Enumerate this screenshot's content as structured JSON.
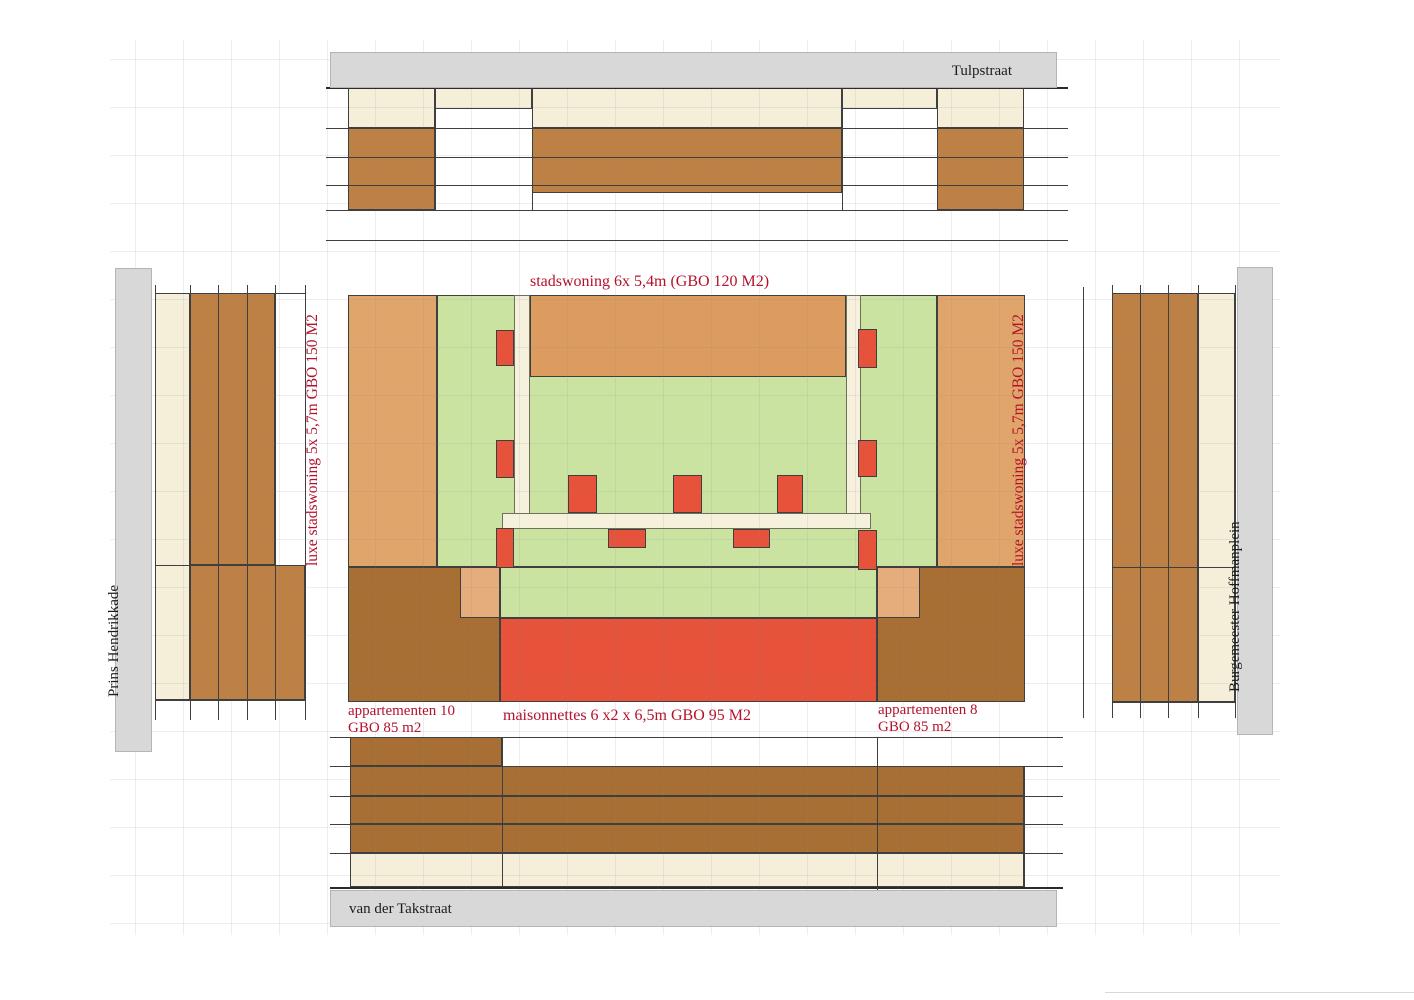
{
  "colors": {
    "cream": "#F5EFD9",
    "green": "#CBE3A0",
    "tan": "#E0A56B",
    "tan_dark": "#DC9B5F",
    "tan_light": "#E4AD7B",
    "brown": "#BE8145",
    "brown_dark": "#A86F35",
    "red": "#E7523A",
    "bar_white": "#F6F1DD",
    "gray_bar": "#D8D8D8",
    "line": "#3F3F3F",
    "line_dark": "#2B2B2B",
    "red_text": "#B4122C",
    "black_text": "#1C1C1C"
  },
  "streets": {
    "top": "Tulpstraat",
    "bottom": "van der Takstraat",
    "left": "Prins Hendrikkade",
    "right": "Burgemeester Hoffmanplein"
  },
  "labels": {
    "stadswoning": "stadswoning 6x 5,4m (GBO 120 M2)",
    "luxe_left": "luxe stadswoning 5x 5,7m GBO 150 M2",
    "luxe_right": "luxe stadswoning 5x 5,7m GBO 150 M2",
    "app10_line1": "appartementen 10",
    "app10_line2": "GBO 85 m2",
    "maisonnettes": "maisonnettes 6 x2 x 6,5m GBO 95 M2",
    "app8_line1": "appartementen 8",
    "app8_line2": "GBO 85 m2"
  }
}
